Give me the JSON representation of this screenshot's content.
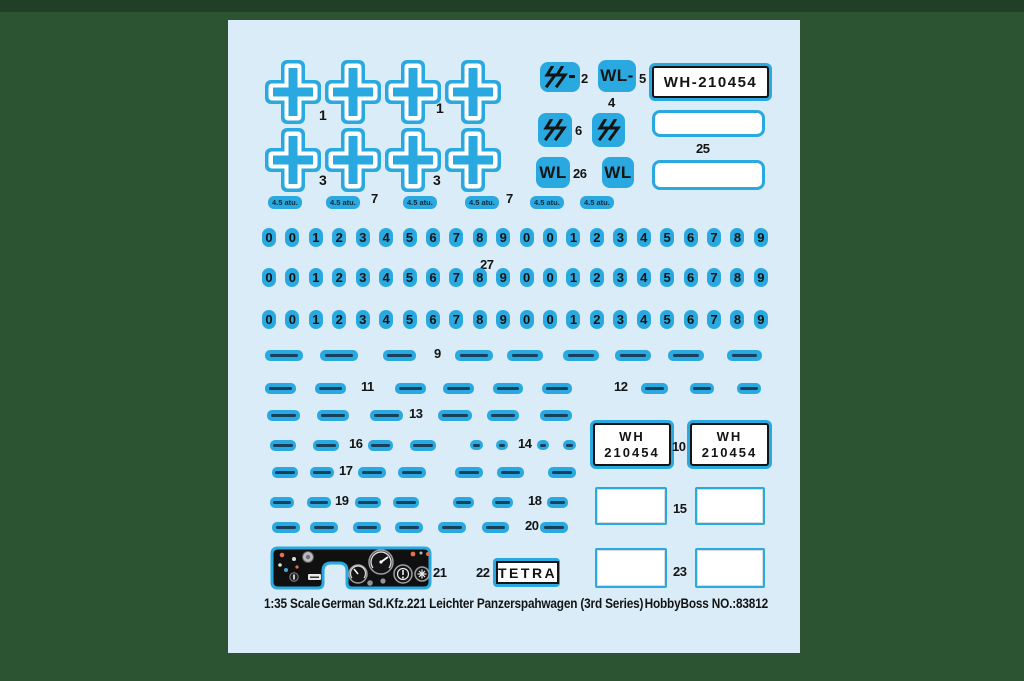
{
  "colors": {
    "page_bg": "#2c5433",
    "sheet_bg": "#d9ecf7",
    "decal_cyan": "#29a9e0",
    "ink": "#141414"
  },
  "cross_section": {
    "row1_label": "1",
    "row2_label": "3"
  },
  "atu_section": {
    "pill_text": "4.5 atu.",
    "seven": "7",
    "y": 176,
    "pill_x": [
      40,
      98,
      175,
      237,
      302,
      352
    ],
    "seven_x": [
      143,
      278
    ]
  },
  "badge_section": {
    "ss_dash": "ϟϟ-",
    "n2": "2",
    "wl_dash": "WL-",
    "n5": "5",
    "plate": "WH-210454",
    "n4": "4",
    "ss": "ϟϟ",
    "n6": "6",
    "n25": "25",
    "wl": "WL",
    "n26": "26"
  },
  "digit_section": {
    "digits": [
      "0",
      "0",
      "1",
      "2",
      "3",
      "4",
      "5",
      "6",
      "7",
      "8",
      "9",
      "0",
      "0",
      "1",
      "2",
      "3",
      "4",
      "5",
      "6",
      "7",
      "8",
      "9"
    ],
    "n27": "27"
  },
  "micro_rows": [
    {
      "y": 330,
      "items": [
        {
          "pill": 38,
          "x": 37
        },
        {
          "pill": 38,
          "x": 92
        },
        {
          "pill": 33,
          "x": 155
        },
        {
          "num": "9",
          "x": 206
        },
        {
          "pill": 38,
          "x": 227
        },
        {
          "pill": 36,
          "x": 279
        },
        {
          "pill": 36,
          "x": 335
        },
        {
          "pill": 36,
          "x": 387
        },
        {
          "pill": 36,
          "x": 440
        },
        {
          "pill": 35,
          "x": 499
        }
      ]
    },
    {
      "y": 363,
      "items": [
        {
          "pill": 31,
          "x": 37
        },
        {
          "pill": 31,
          "x": 87
        },
        {
          "num": "11",
          "x": 133
        },
        {
          "pill": 31,
          "x": 167
        },
        {
          "pill": 31,
          "x": 215
        },
        {
          "pill": 30,
          "x": 265
        },
        {
          "pill": 30,
          "x": 314
        },
        {
          "num": "12",
          "x": 386
        },
        {
          "pill": 27,
          "x": 413
        },
        {
          "pill": 24,
          "x": 462
        },
        {
          "pill": 24,
          "x": 509
        }
      ]
    },
    {
      "y": 390,
      "items": [
        {
          "pill": 33,
          "x": 39
        },
        {
          "pill": 32,
          "x": 89
        },
        {
          "pill": 33,
          "x": 142
        },
        {
          "num": "13",
          "x": 181
        },
        {
          "pill": 34,
          "x": 210
        },
        {
          "pill": 32,
          "x": 259
        },
        {
          "pill": 32,
          "x": 312
        }
      ]
    },
    {
      "y": 420,
      "items": [
        {
          "pill": 26,
          "x": 42
        },
        {
          "pill": 26,
          "x": 85
        },
        {
          "num": "16",
          "x": 121
        },
        {
          "pill": 25,
          "x": 140
        },
        {
          "pill": 26,
          "x": 182
        },
        {
          "pill": 13,
          "x": 242
        },
        {
          "pill": 12,
          "x": 268
        },
        {
          "num": "14",
          "x": 290
        },
        {
          "pill": 12,
          "x": 309
        },
        {
          "pill": 13,
          "x": 335
        }
      ]
    },
    {
      "y": 447,
      "items": [
        {
          "pill": 26,
          "x": 44
        },
        {
          "pill": 24,
          "x": 82
        },
        {
          "num": "17",
          "x": 111
        },
        {
          "pill": 28,
          "x": 130
        },
        {
          "pill": 28,
          "x": 170
        },
        {
          "pill": 28,
          "x": 227
        },
        {
          "pill": 27,
          "x": 269
        },
        {
          "pill": 28,
          "x": 320
        }
      ]
    },
    {
      "y": 477,
      "items": [
        {
          "pill": 24,
          "x": 42
        },
        {
          "pill": 24,
          "x": 79
        },
        {
          "num": "19",
          "x": 107
        },
        {
          "pill": 26,
          "x": 127
        },
        {
          "pill": 26,
          "x": 165
        },
        {
          "pill": 21,
          "x": 225
        },
        {
          "pill": 21,
          "x": 264
        },
        {
          "num": "18",
          "x": 300
        },
        {
          "pill": 21,
          "x": 319
        }
      ]
    },
    {
      "y": 502,
      "items": [
        {
          "pill": 28,
          "x": 44
        },
        {
          "pill": 28,
          "x": 82
        },
        {
          "pill": 28,
          "x": 125
        },
        {
          "pill": 28,
          "x": 167
        },
        {
          "pill": 28,
          "x": 210
        },
        {
          "pill": 27,
          "x": 254
        },
        {
          "num": "20",
          "x": 297
        },
        {
          "pill": 28,
          "x": 312
        }
      ]
    }
  ],
  "plate_section": {
    "wh": "WH",
    "number": "210454",
    "n10": "10",
    "n15": "15"
  },
  "bottom_section": {
    "n21": "21",
    "n22": "22",
    "tetra": "TETRA",
    "n23": "23"
  },
  "footer": {
    "scale": "1:35 Scale",
    "title": "German Sd.Kfz.221 Leichter Panzerspahwagen (3rd Series)",
    "brand": "HobbyBoss NO.:83812"
  }
}
